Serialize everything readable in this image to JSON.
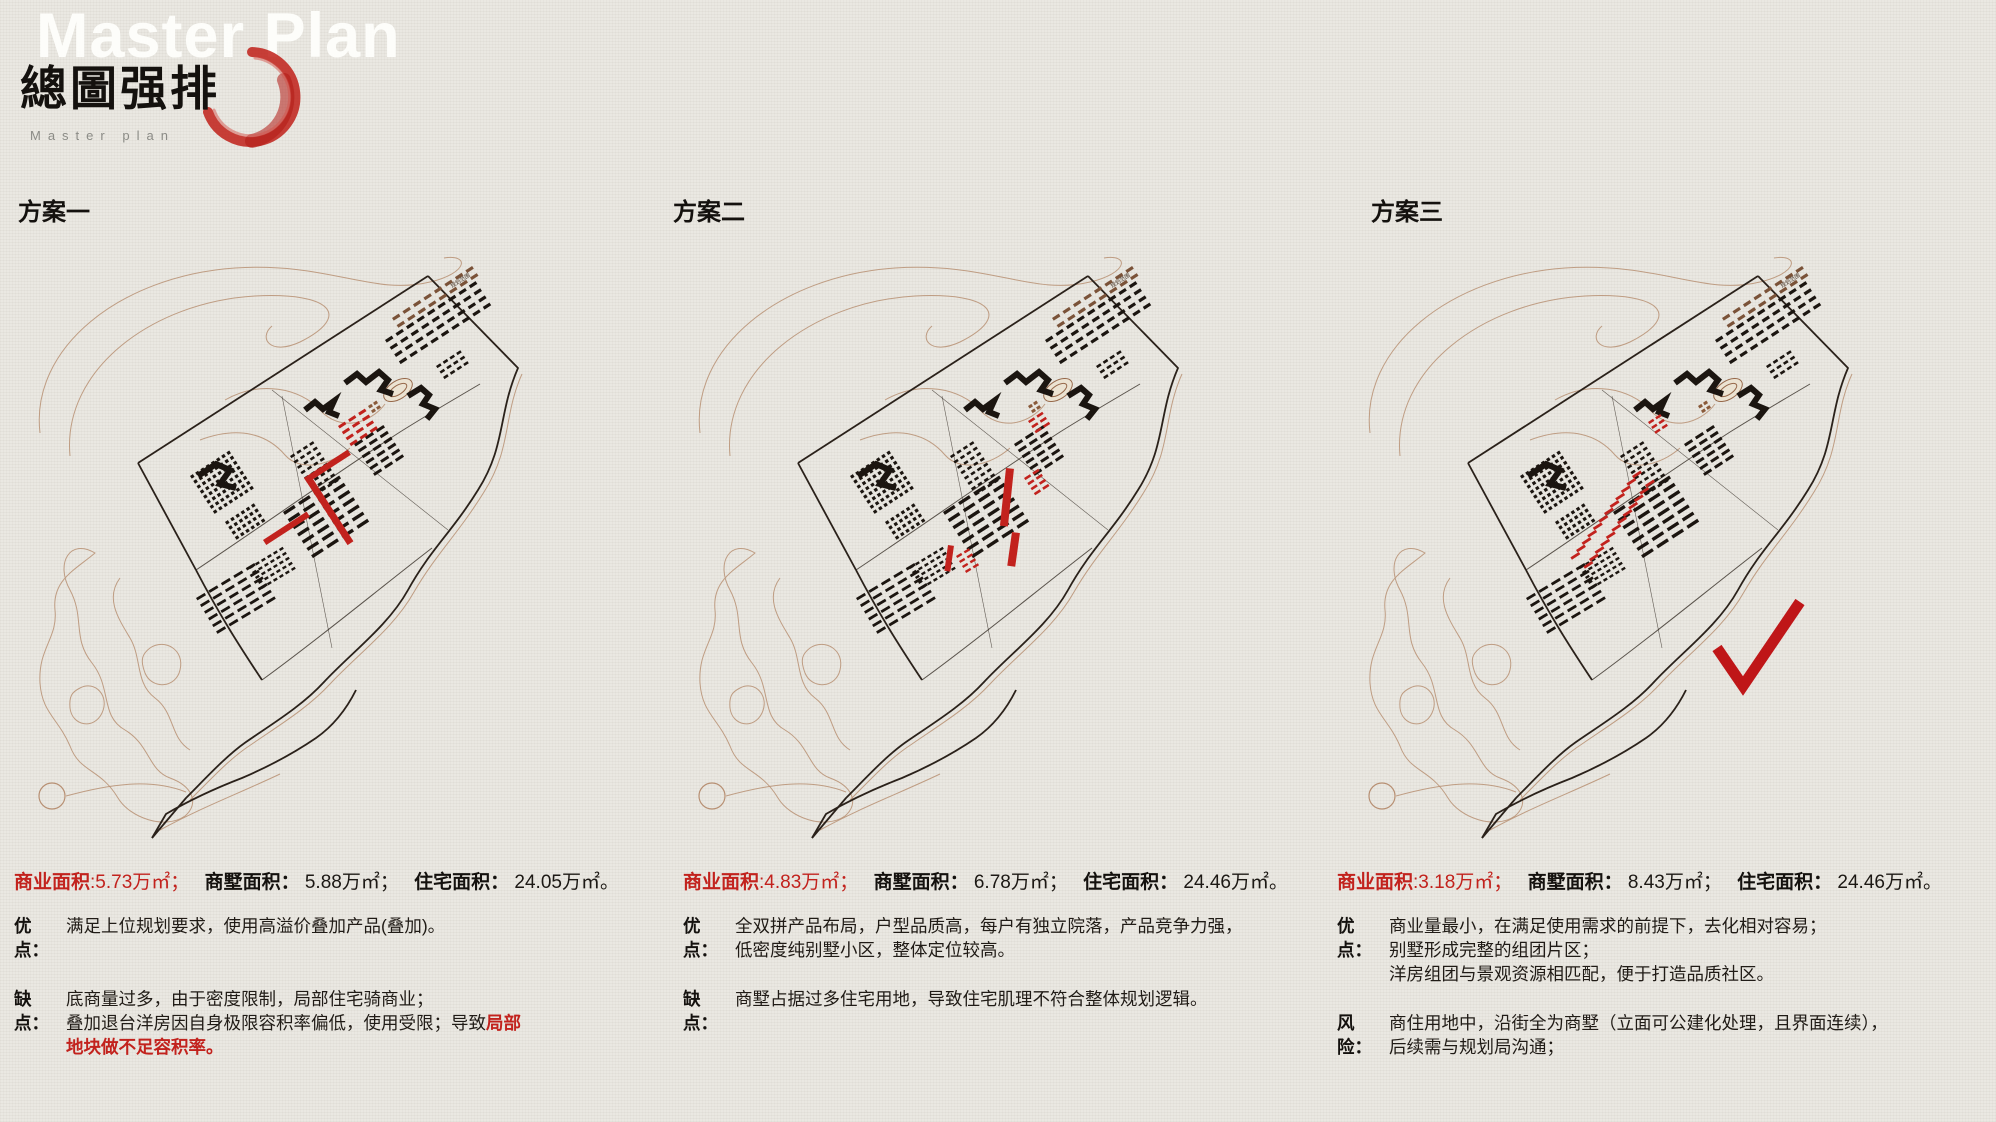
{
  "header": {
    "watermark": "Master Plan",
    "title_cn": "總圖强排",
    "subtitle": "Master plan"
  },
  "map_label": "规划范围",
  "colors": {
    "accent_red": "#c2221d",
    "ink": "#1b1510",
    "contour": "#b78f72",
    "paper": "#eae8e2"
  },
  "schemes": [
    {
      "title": "方案一",
      "selected": false,
      "stats": {
        "commercial_label": "商业面积",
        "commercial_value": ":5.73万㎡；",
        "villa_label": "商墅面积：",
        "villa_value": " 5.88万㎡；",
        "residential_label": "住宅面积：",
        "residential_value": " 24.05万㎡。"
      },
      "points": [
        {
          "label": "优点：",
          "lines": [
            [
              {
                "t": "满足上位规划要求，使用高溢价叠加产品(叠加)。"
              }
            ]
          ]
        },
        {
          "label": "缺点：",
          "lines": [
            [
              {
                "t": "底商量过多，由于密度限制，局部住宅骑商业；"
              }
            ],
            [
              {
                "t": "叠加退台洋房因自身极限容积率偏低，使用受限；导致"
              },
              {
                "t": "局部",
                "red": true
              }
            ],
            [
              {
                "t": "地块做不足容积率。",
                "red": true
              }
            ]
          ]
        }
      ]
    },
    {
      "title": "方案二",
      "selected": false,
      "stats": {
        "commercial_label": "商业面积",
        "commercial_value": ":4.83万㎡；",
        "villa_label": "商墅面积：",
        "villa_value": " 6.78万㎡；",
        "residential_label": "住宅面积：",
        "residential_value": " 24.46万㎡。"
      },
      "points": [
        {
          "label": "优点：",
          "lines": [
            [
              {
                "t": "全双拼产品布局，户型品质高，每户有独立院落，产品竞争力强，"
              }
            ],
            [
              {
                "t": "低密度纯别墅小区，整体定位较高。"
              }
            ]
          ]
        },
        {
          "label": "缺点：",
          "lines": [
            [
              {
                "t": "商墅占据过多住宅用地，导致住宅肌理不符合整体规划逻辑。"
              }
            ]
          ]
        }
      ]
    },
    {
      "title": "方案三",
      "selected": true,
      "stats": {
        "commercial_label": "商业面积",
        "commercial_value": ":3.18万㎡；",
        "villa_label": "商墅面积：",
        "villa_value": " 8.43万㎡；",
        "residential_label": "住宅面积：",
        "residential_value": " 24.46万㎡。"
      },
      "points": [
        {
          "label": "优点：",
          "lines": [
            [
              {
                "t": "商业量最小，在满足使用需求的前提下，去化相对容易；"
              }
            ],
            [
              {
                "t": "别墅形成完整的组团片区；"
              }
            ],
            [
              {
                "t": "洋房组团与景观资源相匹配，便于打造品质社区。"
              }
            ]
          ]
        },
        {
          "label": "风险：",
          "lines": [
            [
              {
                "t": "商住用地中，沿街全为商墅（立面可公建化处理，且界面连续），"
              }
            ],
            [
              {
                "t": "后续需与规划局沟通；"
              }
            ]
          ]
        }
      ]
    }
  ]
}
